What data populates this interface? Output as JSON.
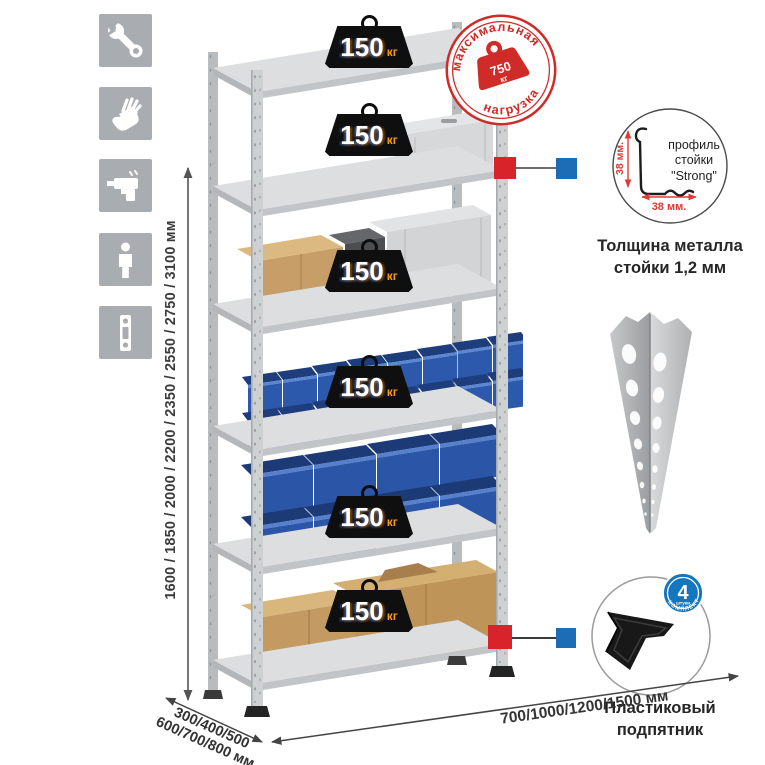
{
  "sidebar": {
    "items": [
      {
        "icon": "wrench-icon"
      },
      {
        "icon": "gloves-icon"
      },
      {
        "icon": "drill-icon"
      },
      {
        "icon": "person-icon"
      },
      {
        "icon": "level-icon"
      }
    ]
  },
  "rack": {
    "shelf_loads": [
      {
        "value": "150",
        "unit": "кг"
      },
      {
        "value": "150",
        "unit": "кг"
      },
      {
        "value": "150",
        "unit": "кг"
      },
      {
        "value": "150",
        "unit": "кг"
      },
      {
        "value": "150",
        "unit": "кг"
      },
      {
        "value": "150",
        "unit": "кг"
      }
    ],
    "max_load_stamp": {
      "arc_top": "максимальная",
      "arc_bottom": "нагрузка",
      "value": "750",
      "unit": "кг"
    }
  },
  "dimensions": {
    "heights": "1600 / 1850 / 2000 / 2200 / 2350 / 2550 / 2750 / 3100 мм",
    "depths_line1": "300/400/500",
    "depths_line2": "600/700/800 мм",
    "widths": "700/1000/1200/1500 мм"
  },
  "profile_detail": {
    "label_line1": "профиль",
    "label_line2": "стойки",
    "label_line3": "\"Strong\"",
    "vertical_dim": "38 мм.",
    "horizontal_dim": "38 мм.",
    "caption_line1": "Толщина металла",
    "caption_line2": "стойки 1,2 мм"
  },
  "foot_detail": {
    "badge_count": "4",
    "badge_unit": "штуки",
    "badge_arc": "в комплекте",
    "caption_line1": "Пластиковый",
    "caption_line2": "подпятник"
  },
  "colors": {
    "accent_red": "#cf2b28",
    "marker_red": "#d8232a",
    "marker_blue": "#1d6db6",
    "bin_blue": "#2e5bb0",
    "steel_gray": "#c9cbcd",
    "icon_gray": "#a9adb2",
    "badge_black": "#0f0f0f",
    "kg_orange": "#f8991d"
  }
}
